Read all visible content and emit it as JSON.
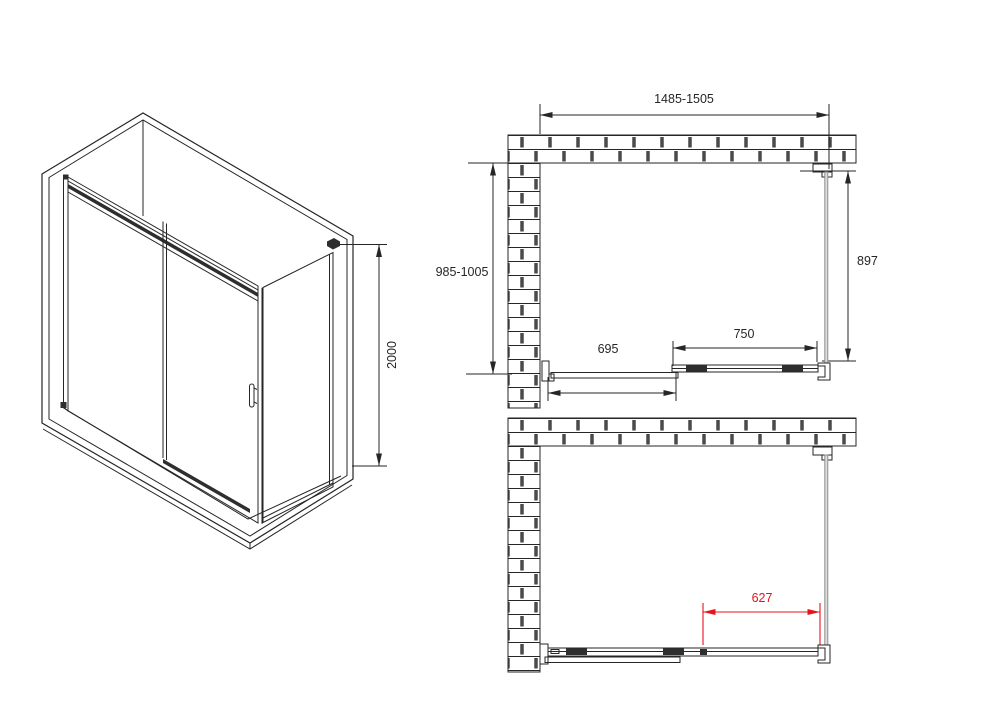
{
  "meta": {
    "title": "Corner shower enclosure with sliding door - technical drawing",
    "background": "#ffffff"
  },
  "colors": {
    "line": "#262626",
    "accent_red": "#e8121c",
    "glass_stroke": "#8f8f8f",
    "glass_fill": "#dcdcdc",
    "hardware_dark": "#2e2e2e"
  },
  "views": {
    "iso": {
      "name": "isometric-view",
      "dim_height": "2000"
    },
    "plan_closed": {
      "name": "top-view-door-closed",
      "dim_width_range": "1485-1505",
      "dim_depth_range": "985-1005",
      "dim_side_panel": "897",
      "dim_door_opening": "695",
      "dim_fixed_panel": "750"
    },
    "plan_open": {
      "name": "top-view-door-open",
      "dim_passage": "627"
    }
  }
}
